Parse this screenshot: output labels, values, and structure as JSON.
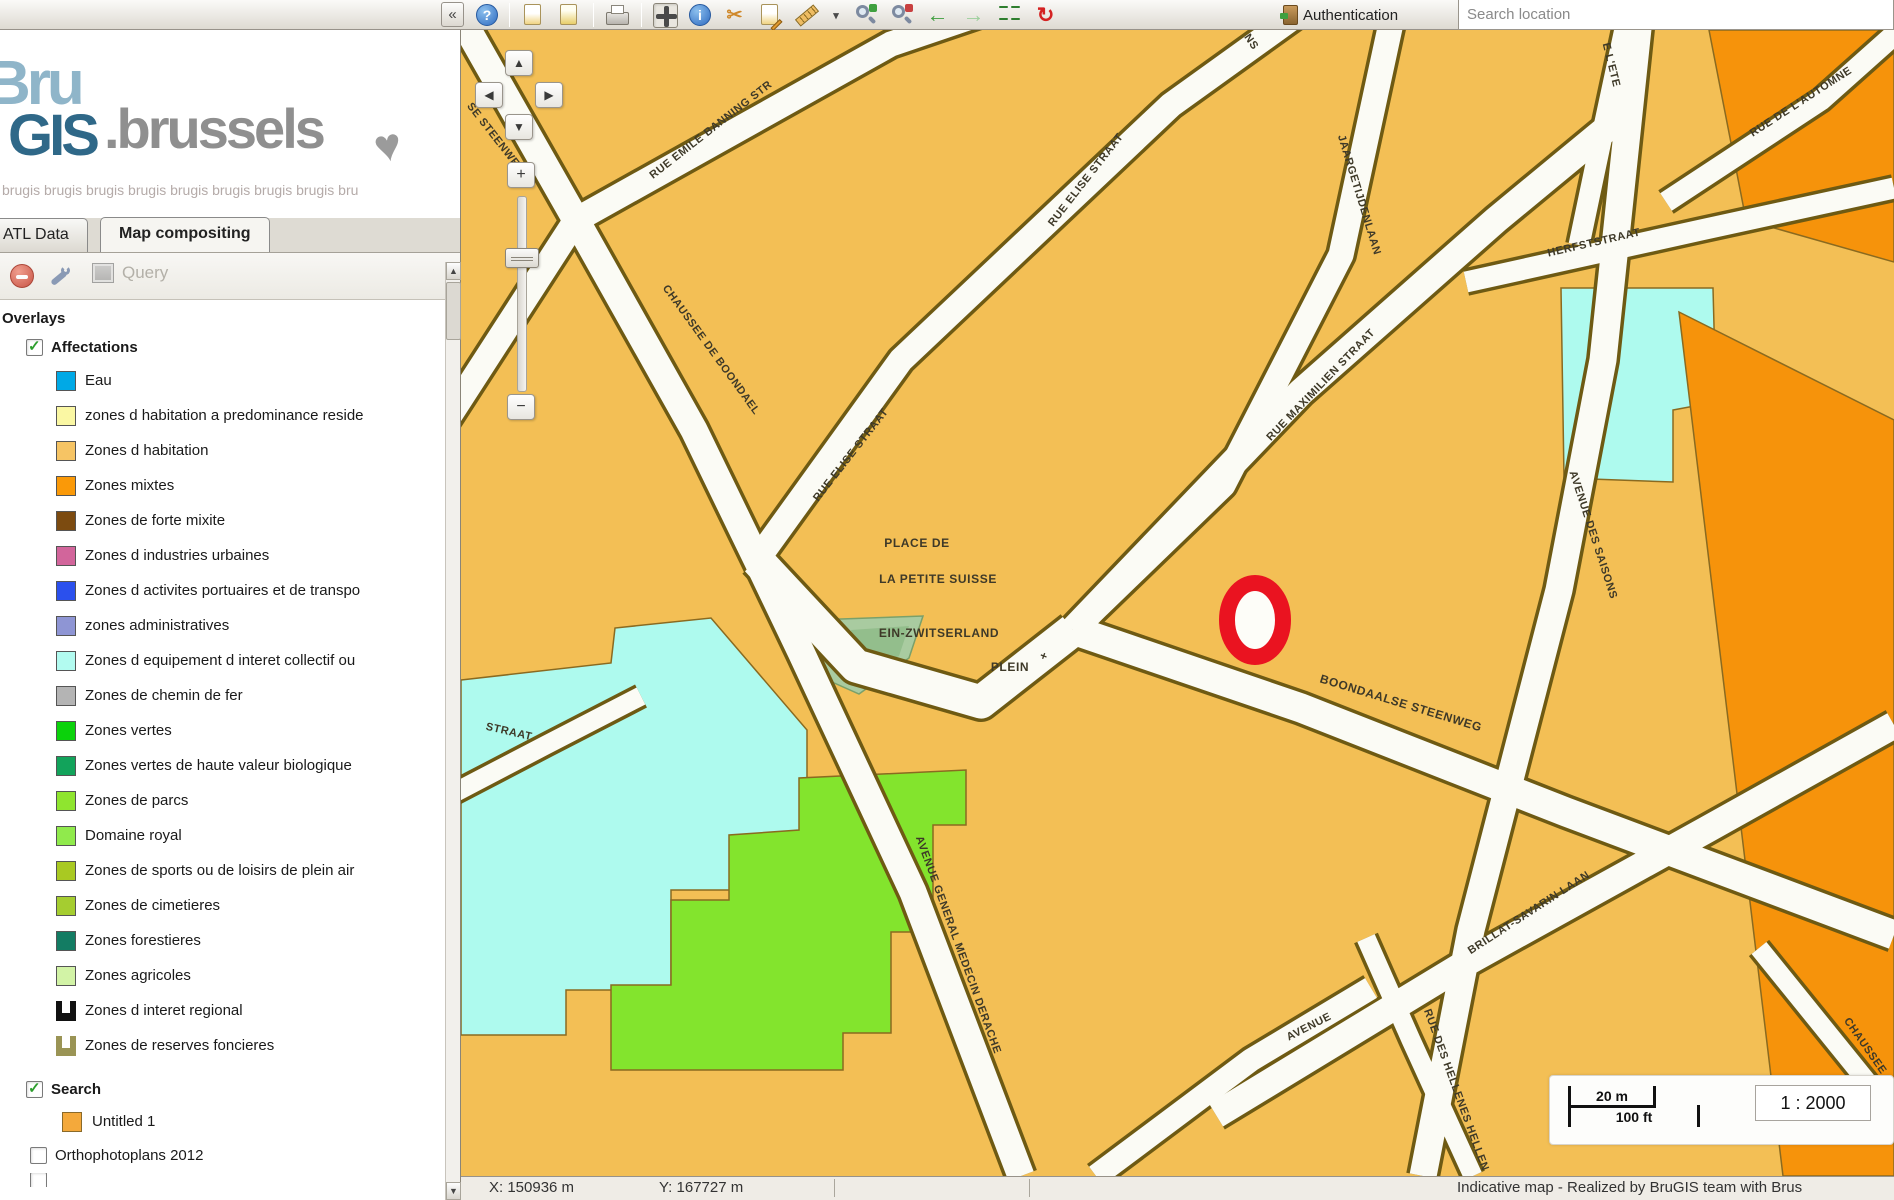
{
  "header": {
    "collapse_label": "«",
    "auth_label": "Authentication",
    "search_placeholder": "Search location",
    "toolbar": {
      "buttons": [
        {
          "name": "help-icon",
          "kind": "circle-blue",
          "glyph": "?"
        },
        {
          "name": "separator",
          "kind": "sep"
        },
        {
          "name": "save-map-icon",
          "kind": "page-yellow"
        },
        {
          "name": "export-map-icon",
          "kind": "page-yellow2"
        },
        {
          "name": "separator",
          "kind": "sep"
        },
        {
          "name": "print-icon",
          "kind": "printer"
        },
        {
          "name": "separator",
          "kind": "sep"
        },
        {
          "name": "pan-icon",
          "kind": "pan",
          "pressed": true
        },
        {
          "name": "info-icon",
          "kind": "circle-blue",
          "glyph": "i"
        },
        {
          "name": "select-cut-icon",
          "kind": "plain-orange",
          "glyph": "✂"
        },
        {
          "name": "edit-page-icon",
          "kind": "page-pencil"
        },
        {
          "name": "measure-icon",
          "kind": "ruler"
        },
        {
          "name": "measure-caret-icon",
          "kind": "caret",
          "glyph": "▾"
        },
        {
          "name": "zoom-in-icon",
          "kind": "magnifier-green"
        },
        {
          "name": "zoom-out-icon",
          "kind": "magnifier-red"
        },
        {
          "name": "previous-extent-icon",
          "kind": "arrow-green",
          "glyph": "←"
        },
        {
          "name": "next-extent-icon",
          "kind": "arrow-green-light",
          "glyph": "→"
        },
        {
          "name": "full-extent-icon",
          "kind": "squares-green"
        },
        {
          "name": "refresh-locate-icon",
          "kind": "refresh-red",
          "glyph": "↻"
        }
      ]
    }
  },
  "sidebar": {
    "logo": {
      "bru": "Bru",
      "gis": "GIS",
      "brussels": ".brussels",
      "heart": "♥",
      "tagline": "brugis brugis brugis brugis brugis brugis brugis brugis bru"
    },
    "tabs": [
      {
        "label": "ATL Data",
        "active": false
      },
      {
        "label": "Map compositing",
        "active": true
      }
    ],
    "toolbar": {
      "query_label": "Query"
    },
    "tree": {
      "overlays_label": "Overlays",
      "affectations_label": "Affectations",
      "affectations_checked": true,
      "items": [
        {
          "label": "Eau",
          "color": "#00a9e6"
        },
        {
          "label": "zones d habitation a predominance reside",
          "color": "#faf7a3"
        },
        {
          "label": "Zones d habitation",
          "color": "#f6c464"
        },
        {
          "label": "Zones mixtes",
          "color": "#fa9908"
        },
        {
          "label": "Zones de forte mixite",
          "color": "#7c4b10"
        },
        {
          "label": "Zones d industries urbaines",
          "color": "#d2659b"
        },
        {
          "label": "Zones d activites portuaires et de transpo",
          "color": "#2b50ed"
        },
        {
          "label": "zones administratives",
          "color": "#8e95d4"
        },
        {
          "label": "Zones d equipement d interet collectif ou",
          "color": "#b2fbf0"
        },
        {
          "label": "Zones de chemin de fer",
          "color": "#b4b4b4"
        },
        {
          "label": "Zones vertes",
          "color": "#0bd20b"
        },
        {
          "label": "Zones vertes de haute valeur biologique",
          "color": "#12a35b"
        },
        {
          "label": "Zones de parcs",
          "color": "#8fe52f"
        },
        {
          "label": "Domaine royal",
          "color": "#90ea4c"
        },
        {
          "label": "Zones de sports ou de loisirs de plein air",
          "color": "#a9c922"
        },
        {
          "label": "Zones de cimetieres",
          "color": "#a5cd30"
        },
        {
          "label": "Zones forestieres",
          "color": "#137c63"
        },
        {
          "label": "Zones agricoles",
          "color": "#d2f3a6"
        },
        {
          "label": "Zones d interet regional",
          "color": "#111111",
          "swatch": "u"
        },
        {
          "label": "Zones de reserves foncieres",
          "color": "#9a9455",
          "swatch": "u"
        }
      ],
      "search_label": "Search",
      "search_checked": true,
      "untitled_label": "Untitled 1",
      "untitled_color": "#f4a93b",
      "ortho_label": "Orthophotoplans 2012",
      "ortho_checked": false
    },
    "scrollbar": {
      "up": "▲",
      "down": "▼"
    }
  },
  "map": {
    "controls": {
      "up": "▲",
      "left": "◀",
      "right": "▶",
      "down": "▼",
      "zoom_in": "+",
      "zoom_out": "−"
    },
    "labels": [
      {
        "text": "RUE EMILE BANNING STR",
        "x": 250,
        "y": 100,
        "rot": -38
      },
      {
        "text": "SE STEENWE",
        "x": 32,
        "y": 105,
        "rot": 52
      },
      {
        "text": "CHAUSSEE DE BOONDAEL",
        "x": 250,
        "y": 320,
        "rot": 54
      },
      {
        "text": "RUE ELISE STRAAT",
        "x": 390,
        "y": 425,
        "rot": -52
      },
      {
        "text": "RUE ELISE STRAAT",
        "x": 625,
        "y": 150,
        "rot": -52
      },
      {
        "text": "NS",
        "x": 790,
        "y": 12,
        "rot": 55
      },
      {
        "text": "JAARGETIJDENLAAN",
        "x": 898,
        "y": 165,
        "rot": 73
      },
      {
        "text": "RUE MAXIMILIEN STRAAT",
        "x": 860,
        "y": 355,
        "rot": -46
      },
      {
        "text": "HERFSTSTRAAT",
        "x": 1133,
        "y": 213,
        "rot": -13
      },
      {
        "text": "RUE DE L'AUTOMNE",
        "x": 1340,
        "y": 72,
        "rot": -33
      },
      {
        "text": "E L'ETE",
        "x": 1150,
        "y": 35,
        "rot": 76
      },
      {
        "text": "AVENUE DES SAISONS",
        "x": 1132,
        "y": 505,
        "rot": 72
      },
      {
        "text": "PLACE DE",
        "x": 456,
        "y": 513,
        "rot": 0,
        "big": true
      },
      {
        "text": "LA PETITE SUISSE",
        "x": 477,
        "y": 549,
        "rot": 0,
        "big": true
      },
      {
        "text": "EIN-ZWITSERLAND",
        "x": 478,
        "y": 603,
        "rot": 0,
        "big": true
      },
      {
        "text": "PLEIN",
        "x": 549,
        "y": 637,
        "rot": 0,
        "big": true
      },
      {
        "text": "+",
        "x": 583,
        "y": 626,
        "rot": 20,
        "big": true
      },
      {
        "text": "BOONDAALSE STEENWEG",
        "x": 940,
        "y": 673,
        "rot": 17,
        "big": true
      },
      {
        "text": "AVENUE GENERAL MEDECIN DERACHE",
        "x": 497,
        "y": 915,
        "rot": 70
      },
      {
        "text": "AVENUE",
        "x": 848,
        "y": 997,
        "rot": -27
      },
      {
        "text": "BRILLAT-SAVARIN LAAN",
        "x": 1068,
        "y": 883,
        "rot": -33
      },
      {
        "text": "RUE DES HELLENES HELLEN",
        "x": 995,
        "y": 1060,
        "rot": 70
      },
      {
        "text": "CHAUSSEE",
        "x": 1404,
        "y": 1016,
        "rot": 55
      },
      {
        "text": "STRAAT",
        "x": 48,
        "y": 702,
        "rot": 13
      }
    ],
    "scale": {
      "meters": "20 m",
      "feet": "100 ft",
      "ratio": "1 : 2000"
    },
    "colors": {
      "background": "#f3bf55",
      "road": "#fbfbf5",
      "casing": "#6e5a13",
      "orange": "#f6930b",
      "cyan": "#aefaee",
      "green": "#83e42d",
      "park": "#a9cba0",
      "marker": "#ea1320"
    }
  },
  "statusbar": {
    "x_label": "X: 150936 m",
    "y_label": "Y: 167727 m",
    "credit": "Indicative map - Realized by BruGIS team with Brus"
  }
}
